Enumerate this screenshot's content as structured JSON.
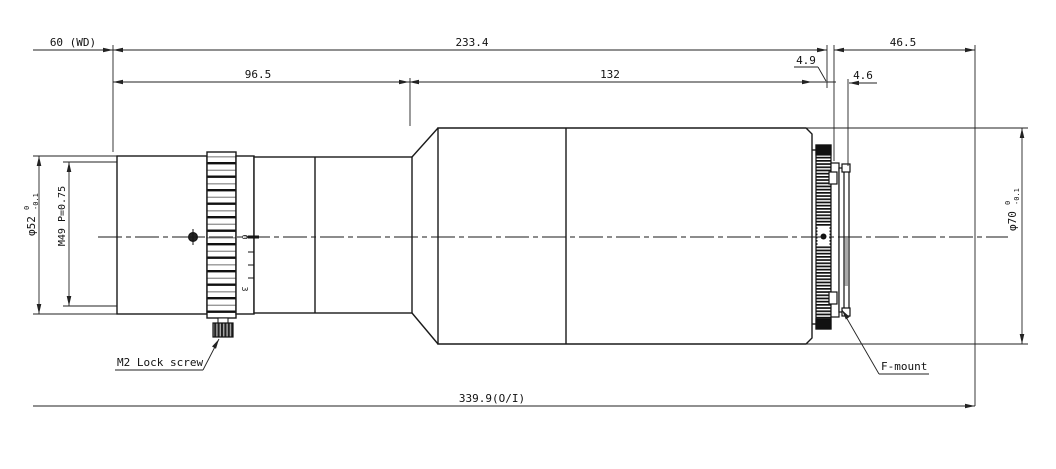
{
  "drawing": {
    "type": "lens-mechanical-drawing",
    "dimensions_top": {
      "working_distance": "60 (WD)",
      "optical_length": "233.4",
      "flange_distance": "46.5"
    },
    "dimensions_mid": {
      "front_length": "96.5",
      "mid_length": "132",
      "step1": "4.9",
      "step2": "4.6"
    },
    "dimension_bottom": {
      "overall": "339.9(O/I)"
    },
    "diameters": {
      "front": "φ52",
      "front_tol_upper": "0",
      "front_tol_lower": "-0.1",
      "thread": "M49 P=0.75",
      "rear": "φ70",
      "rear_tol_upper": "0",
      "rear_tol_lower": "-0.1"
    },
    "labels": {
      "lock_screw": "M2 Lock screw",
      "mount": "F-mount"
    },
    "focus_scale": {
      "mark_zero": "0",
      "mark_three": "3"
    },
    "colors": {
      "line": "#1a1a1a",
      "dimension": "#222222",
      "background": "#ffffff"
    }
  }
}
